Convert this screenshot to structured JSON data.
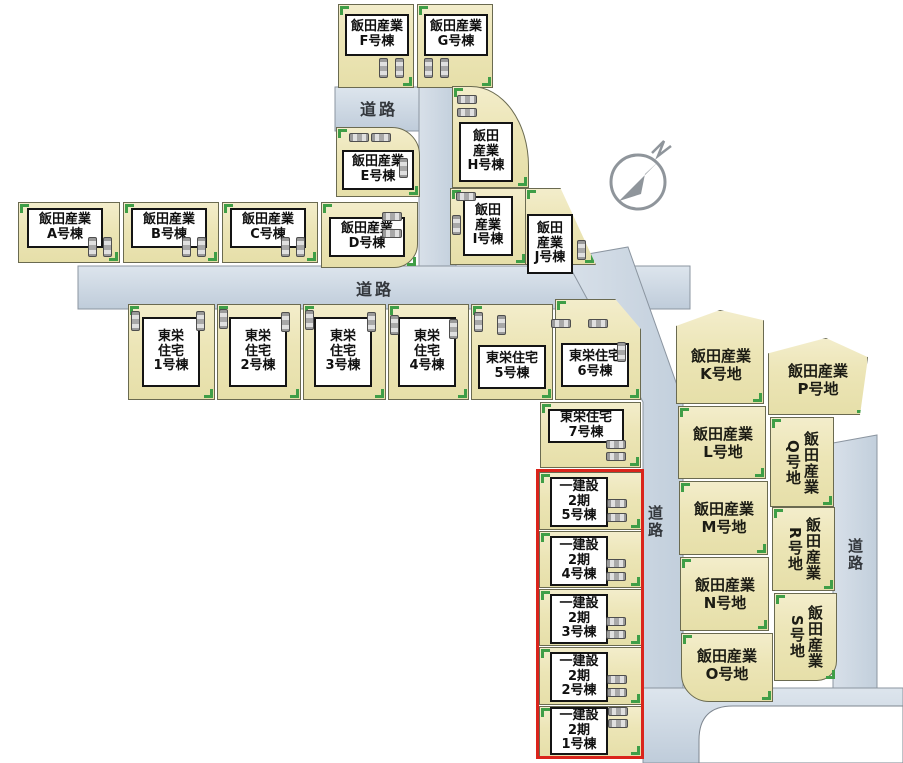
{
  "colors": {
    "lot_fill": "#ece5b6",
    "lot_border": "#6a6a50",
    "road_fill_top": "#dfe6ee",
    "road_fill_bottom": "#bfccda",
    "building_fill": "#ffffff",
    "building_border": "#141414",
    "corner_tick_green": "#3f9e47",
    "highlight_red": "#da241b",
    "car_gray": "#a8a8a8",
    "compass_gray": "#8f959b",
    "text_dark": "#1c1c14"
  },
  "compass": {
    "north_label": "N"
  },
  "road_labels": [
    {
      "id": "road-top",
      "text": "道路"
    },
    {
      "id": "road-middle",
      "text": "道路"
    },
    {
      "id": "road-center-vertical",
      "text": "道路"
    },
    {
      "id": "road-right-vertical",
      "text": "道路"
    }
  ],
  "lots": [
    {
      "id": "iida-f",
      "kind": "building",
      "label": "飯田産業\nF号棟"
    },
    {
      "id": "iida-g",
      "kind": "building",
      "label": "飯田産業\nG号棟"
    },
    {
      "id": "iida-e",
      "kind": "building",
      "label": "飯田産業\nE号棟"
    },
    {
      "id": "iida-h",
      "kind": "building",
      "label": "飯田\n産業\nH号棟"
    },
    {
      "id": "iida-a",
      "kind": "building",
      "label": "飯田産業\nA号棟"
    },
    {
      "id": "iida-b",
      "kind": "building",
      "label": "飯田産業\nB号棟"
    },
    {
      "id": "iida-c",
      "kind": "building",
      "label": "飯田産業\nC号棟"
    },
    {
      "id": "iida-d",
      "kind": "building",
      "label": "飯田産業\nD号棟"
    },
    {
      "id": "iida-i",
      "kind": "building",
      "label": "飯田\n産業\nI号棟"
    },
    {
      "id": "iida-j",
      "kind": "building",
      "label": "飯田\n産業\nJ号棟"
    },
    {
      "id": "toei-1",
      "kind": "building",
      "label": "東栄\n住宅\n1号棟"
    },
    {
      "id": "toei-2",
      "kind": "building",
      "label": "東栄\n住宅\n2号棟"
    },
    {
      "id": "toei-3",
      "kind": "building",
      "label": "東栄\n住宅\n3号棟"
    },
    {
      "id": "toei-4",
      "kind": "building",
      "label": "東栄\n住宅\n4号棟"
    },
    {
      "id": "toei-5",
      "kind": "building",
      "label": "東栄住宅\n5号棟"
    },
    {
      "id": "toei-6",
      "kind": "building",
      "label": "東栄住宅\n6号棟"
    },
    {
      "id": "toei-7",
      "kind": "building",
      "label": "東栄住宅\n7号棟"
    },
    {
      "id": "hajime-5",
      "kind": "building",
      "label": "一建設\n2期\n5号棟"
    },
    {
      "id": "hajime-4",
      "kind": "building",
      "label": "一建設\n2期\n4号棟"
    },
    {
      "id": "hajime-3",
      "kind": "building",
      "label": "一建設\n2期\n3号棟"
    },
    {
      "id": "hajime-2",
      "kind": "building",
      "label": "一建設\n2期\n2号棟"
    },
    {
      "id": "hajime-1",
      "kind": "building",
      "label": "一建設\n2期\n1号棟"
    },
    {
      "id": "iida-k",
      "kind": "land",
      "label": "飯田産業\nK号地"
    },
    {
      "id": "iida-l",
      "kind": "land",
      "label": "飯田産業\nL号地"
    },
    {
      "id": "iida-m",
      "kind": "land",
      "label": "飯田産業\nM号地"
    },
    {
      "id": "iida-n",
      "kind": "land",
      "label": "飯田産業\nN号地"
    },
    {
      "id": "iida-o",
      "kind": "land",
      "label": "飯田産業\nO号地"
    },
    {
      "id": "iida-p",
      "kind": "land",
      "label": "飯田産業\nP号地"
    },
    {
      "id": "iida-q",
      "kind": "land",
      "label": "飯田産業\nQ号地"
    },
    {
      "id": "iida-r",
      "kind": "land",
      "label": "飯田産業\nR号地"
    },
    {
      "id": "iida-s",
      "kind": "land",
      "label": "飯田産業\nS号地"
    }
  ]
}
